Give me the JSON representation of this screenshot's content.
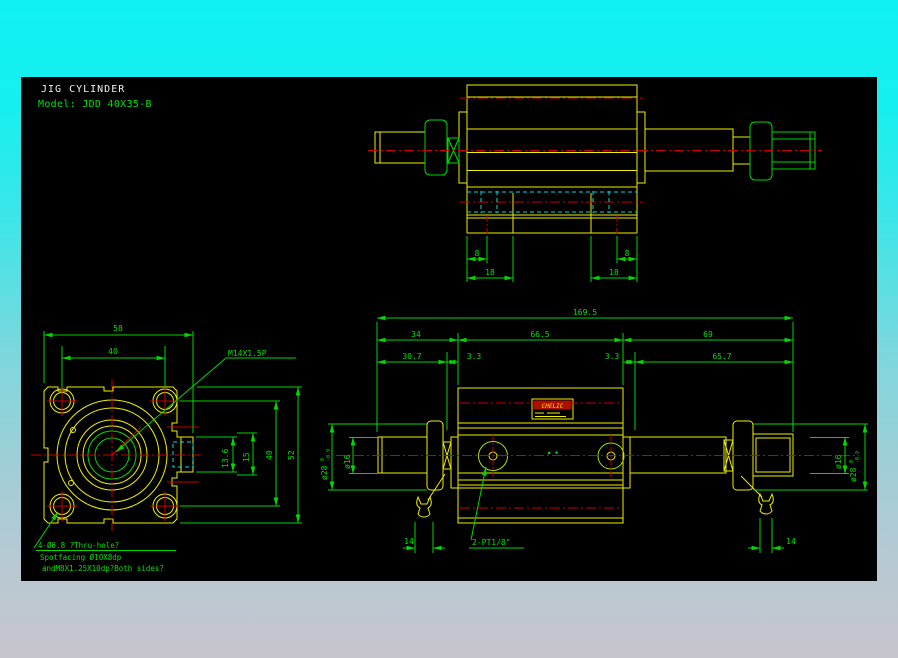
{
  "title": "JIG CYLINDER",
  "model": "Model: JDD 40X35-B",
  "colors": {
    "canvas": "#000000",
    "outline_yellow": "#f0f000",
    "dimension_green": "#00d900",
    "centerline_red": "#c80000",
    "hidden_cyan": "#00dcdc",
    "title_white": "#f2f2f2",
    "background_top": "#10f2f2",
    "background_bottom": "#c6c5cd"
  },
  "top_view": {
    "dim_hole_offset": "8",
    "dim_foot_width": "18"
  },
  "side_view": {
    "dim_total": "169.5",
    "dim_left": "34",
    "dim_body": "66.5",
    "dim_right": "69",
    "dim_left_rod": "30.7",
    "dim_gap": "3.3",
    "dim_right_rod": "65.7",
    "dim_wrench": "14",
    "dia_rod": "ø16",
    "dia_boss": "ø28",
    "boss_tol_sup": "0",
    "boss_tol_sub": "-0.9",
    "port_label": "2-PT1/8\"",
    "brand_label": "CHELIC"
  },
  "front_view": {
    "dim_width": "58",
    "dim_bolt_spacing": "40",
    "dim_13_6": "13.6",
    "dim_15": "15",
    "dim_height": "52",
    "thread_label": "M14X1.5P",
    "note_line1": "4-Ø6.8 ?Thru-hole?",
    "note_line2": "Spotfacing Ø10X8dp",
    "note_line3": "andM8X1.25X10dp?Both sides?"
  }
}
